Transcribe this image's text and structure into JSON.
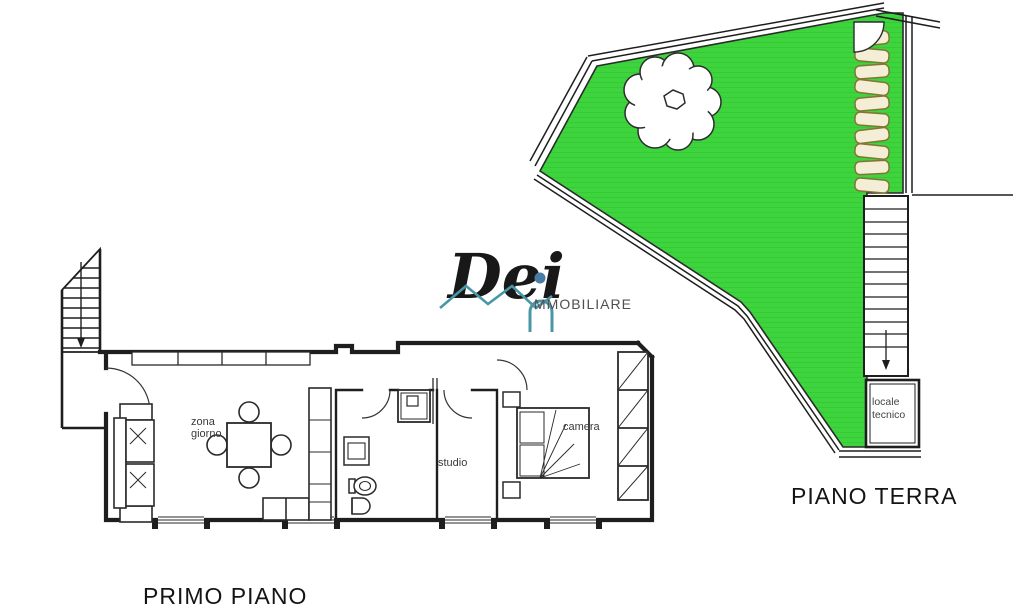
{
  "labels": {
    "ground_floor_title": "PIANO TERRA",
    "first_floor_title": "PRIMO PIANO",
    "zona_giorno_line1": "zona",
    "zona_giorno_line2": "giorno",
    "studio": "studio",
    "camera": "camera",
    "locale_tecnico_line1": "locale",
    "locale_tecnico_line2": "tecnico"
  },
  "logo": {
    "script_text": "Dei",
    "suffix_text": "MMOBILIARE"
  },
  "colors": {
    "garden_green": "#3ed43e",
    "garden_hatch": "#2fc32f",
    "stone_fill": "#f5eed6",
    "stone_border": "#837634",
    "wall_line": "#1e1e1e",
    "logo_teal": "#4a96a6",
    "logo_dot": "#4a7ca6"
  }
}
